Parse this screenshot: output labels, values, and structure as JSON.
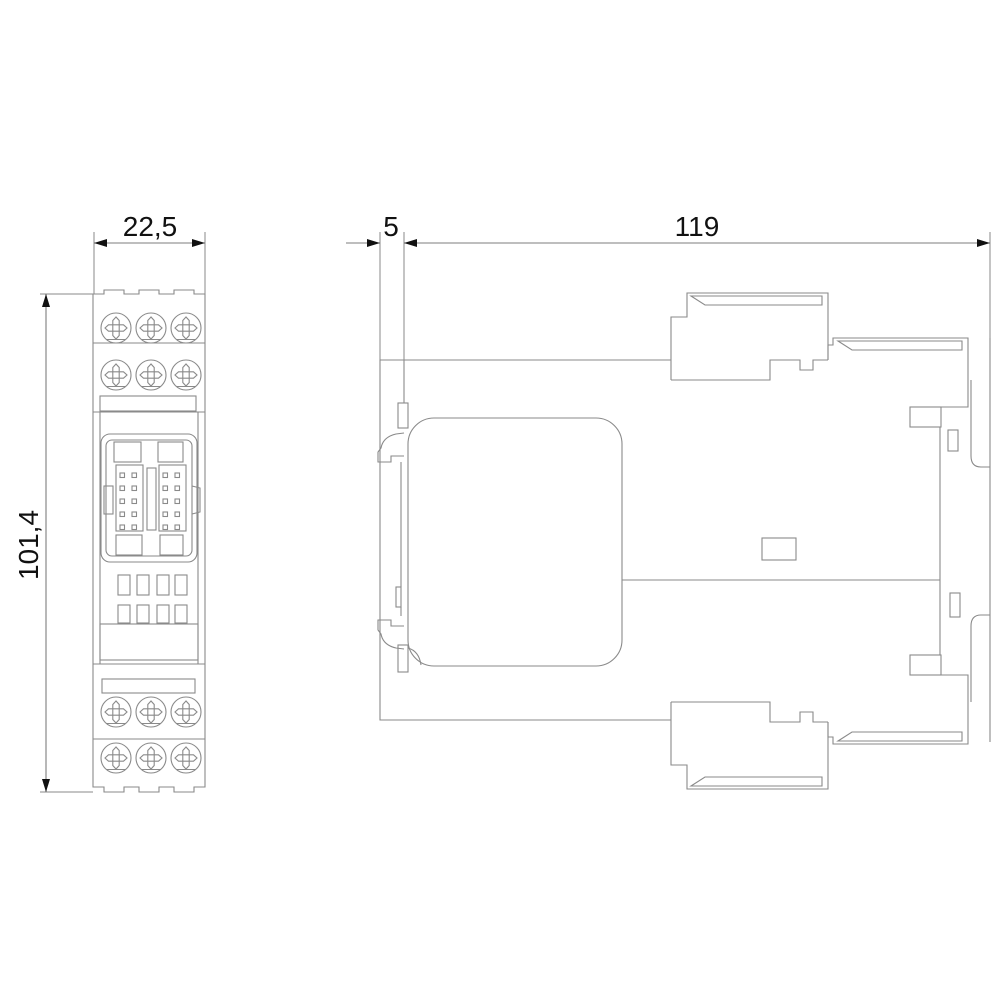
{
  "drawing_type": "dimensional-drawing",
  "dimensions": {
    "front_width_mm": "22,5",
    "front_height_mm": "101,4",
    "side_rail_offset_mm": "5",
    "side_depth_mm": "119"
  },
  "colors": {
    "background": "#ffffff",
    "part_lines": "#8a8a8a",
    "dimension_lines": "#7d7d7d",
    "annotations": "#111111"
  }
}
